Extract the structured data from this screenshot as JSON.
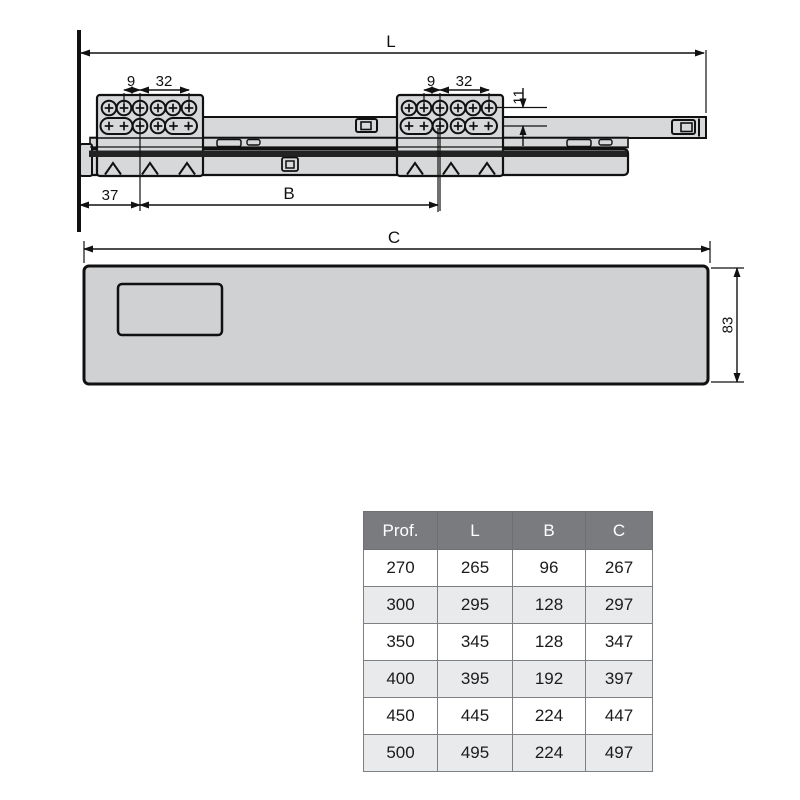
{
  "drawing": {
    "slide": {
      "dim_L": "L",
      "dim_37": "37",
      "dim_B": "B",
      "dim_11": "11",
      "left_bracket": {
        "dim_9": "9",
        "dim_32": "32"
      },
      "right_bracket": {
        "dim_9": "9",
        "dim_32": "32"
      }
    },
    "panel": {
      "dim_C": "C",
      "dim_83": "83"
    }
  },
  "table": {
    "headers": [
      "Prof.",
      "L",
      "B",
      "C"
    ],
    "rows": [
      [
        "270",
        "265",
        "96",
        "267"
      ],
      [
        "300",
        "295",
        "128",
        "297"
      ],
      [
        "350",
        "345",
        "128",
        "347"
      ],
      [
        "400",
        "395",
        "192",
        "397"
      ],
      [
        "450",
        "445",
        "224",
        "447"
      ],
      [
        "500",
        "495",
        "224",
        "497"
      ]
    ]
  },
  "colors": {
    "line": "#111111",
    "metal_fill": "#d7d8da",
    "panel_fill": "#cfd1d3",
    "dark_band": "#232323",
    "table_header_bg": "#797b7f",
    "table_header_text": "#ffffff",
    "table_row_alt": "#e9eaeb",
    "table_border": "#7d7f82"
  }
}
